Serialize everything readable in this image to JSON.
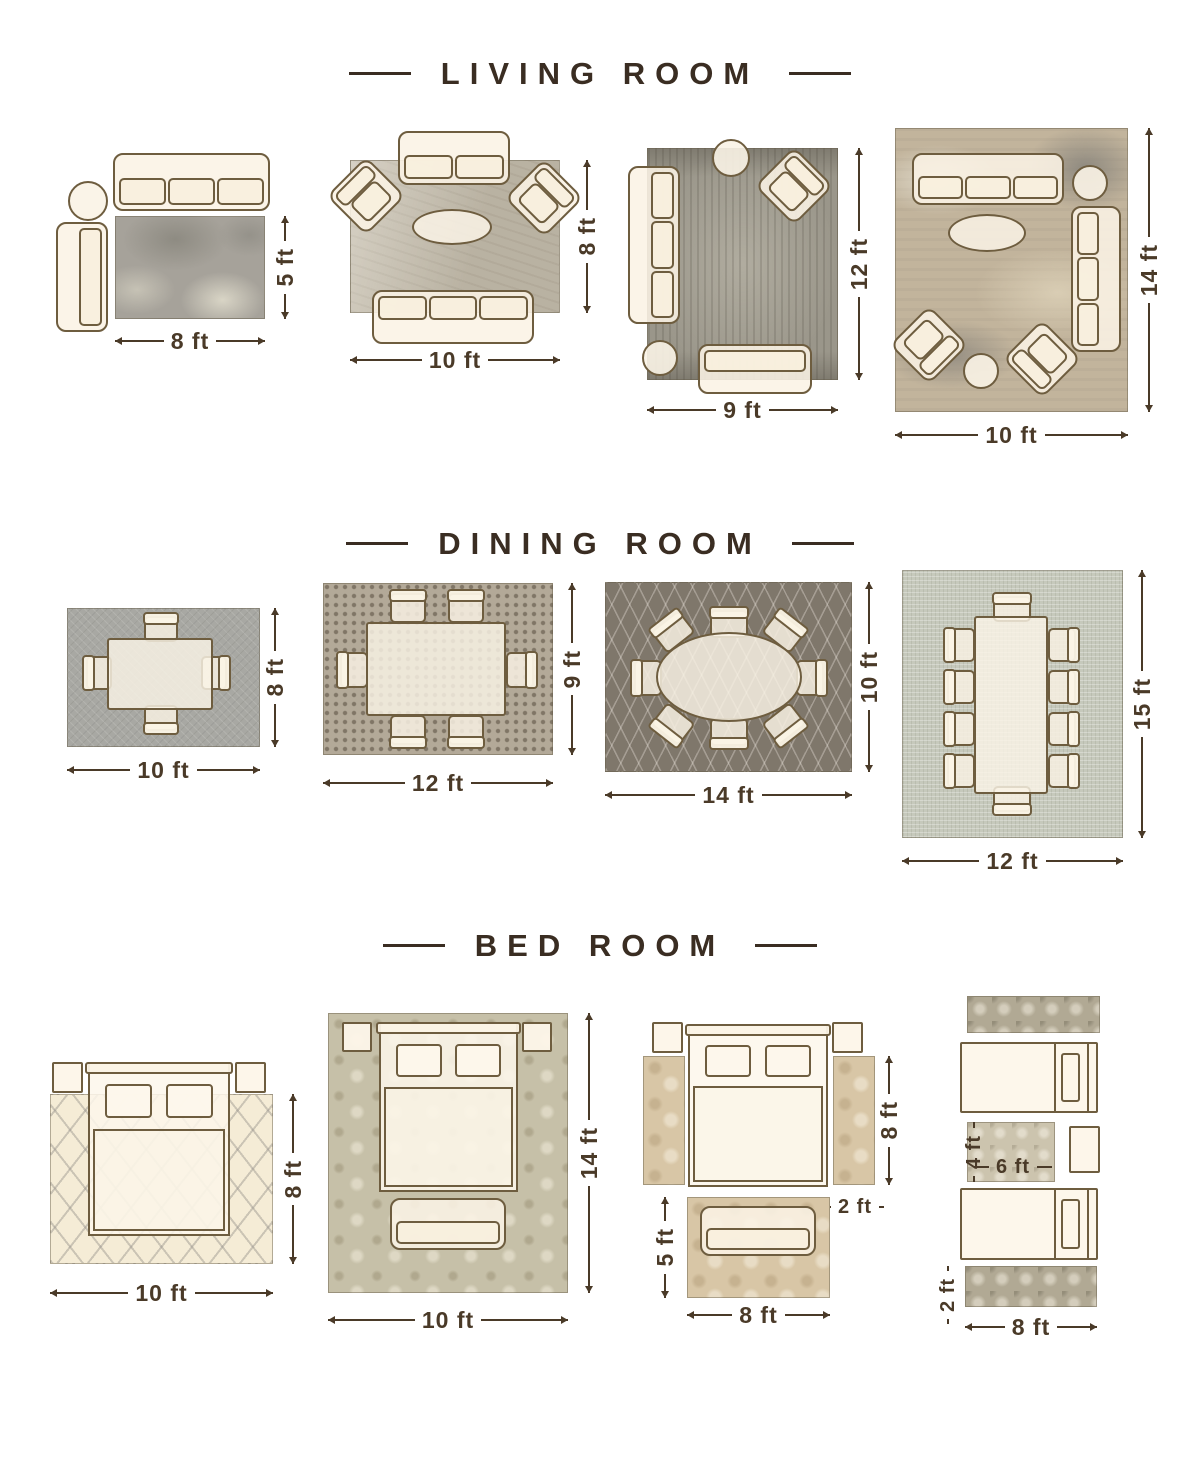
{
  "titles": {
    "living": "LIVING ROOM",
    "dining": "DINING ROOM",
    "bed": "BED ROOM"
  },
  "living": {
    "l1": {
      "w": "8 ft",
      "h": "5 ft"
    },
    "l2": {
      "w": "10 ft",
      "h": "8 ft"
    },
    "l3": {
      "w": "9 ft",
      "h": "12 ft"
    },
    "l4": {
      "w": "10 ft",
      "h": "14 ft"
    }
  },
  "dining": {
    "d1": {
      "w": "10 ft",
      "h": "8 ft"
    },
    "d2": {
      "w": "12 ft",
      "h": "9 ft"
    },
    "d3": {
      "w": "14 ft",
      "h": "10 ft"
    },
    "d4": {
      "w": "12 ft",
      "h": "15 ft"
    }
  },
  "bed": {
    "b1": {
      "w": "10 ft",
      "h": "8 ft"
    },
    "b2": {
      "w": "10 ft",
      "h": "14 ft"
    },
    "b3": {
      "bed_height": "8 ft",
      "runner_width": "2 ft",
      "rug_height": "5 ft",
      "rug_width": "8 ft"
    },
    "b4": {
      "middle_rug_height": "4 ft",
      "middle_rug_width": "6 ft",
      "runner_height": "2 ft",
      "runner_width": "8 ft"
    }
  }
}
